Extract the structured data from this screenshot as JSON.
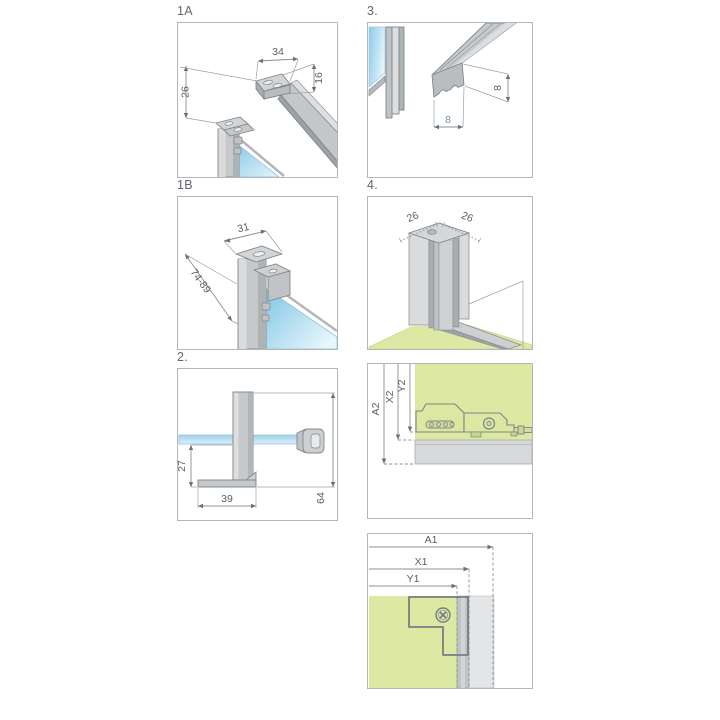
{
  "panels": {
    "p1a": {
      "label": "1A",
      "width_mm": "34",
      "depth_mm": "16",
      "offset_mm": "26"
    },
    "p3": {
      "label": "3.",
      "seal_height_mm": "8",
      "seal_width_mm": "8"
    },
    "p1b": {
      "label": "1B",
      "width_mm": "31",
      "adjust_range_mm": "74-89"
    },
    "p4": {
      "label": "4.",
      "left_mm": "26",
      "right_mm": "26"
    },
    "p2": {
      "label": "2.",
      "drop_mm": "27",
      "foot_mm": "39",
      "height_mm": "64"
    },
    "p5": {
      "dim_a": "A2",
      "dim_x": "X2",
      "dim_y": "Y2"
    },
    "p6": {
      "dim_a": "A1",
      "dim_x": "X1",
      "dim_y": "Y1"
    }
  },
  "colors": {
    "glass_blue": "#8ccae9",
    "glass_blue_light": "#e3f4fc",
    "wall_green": "#dde9a3",
    "metal_light": "#d9dbdd",
    "metal_mid": "#c6c9cc",
    "metal_dark": "#aeb3b6",
    "outline": "#82878b",
    "dim_line": "#8a9094",
    "text": "#585f65",
    "accent_dim": "#6c94ad",
    "panel_border": "#b3b7ba"
  },
  "icons": [
    "screw-icon",
    "slot-icon",
    "screw-head-icon"
  ]
}
